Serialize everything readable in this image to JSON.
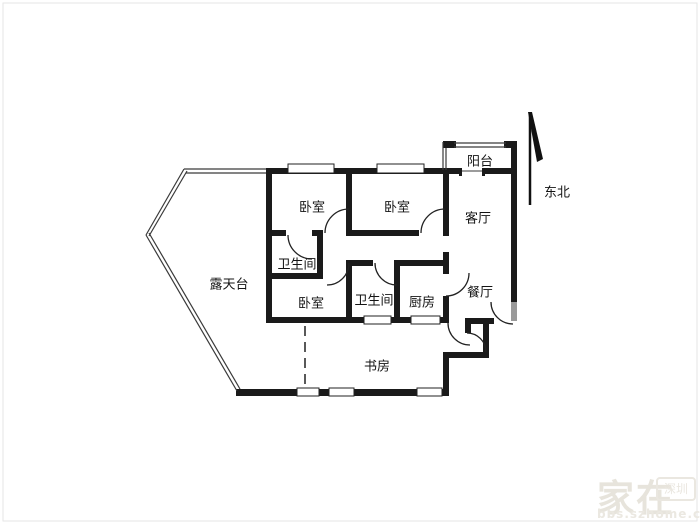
{
  "floorplan": {
    "rooms": [
      {
        "id": "balcony",
        "label": "阳台"
      },
      {
        "id": "bedroom-top-left",
        "label": "卧室"
      },
      {
        "id": "bedroom-top-right",
        "label": "卧室"
      },
      {
        "id": "living-room",
        "label": "客厅"
      },
      {
        "id": "bathroom-1",
        "label": "卫生间"
      },
      {
        "id": "terrace",
        "label": "露天台"
      },
      {
        "id": "bedroom-bottom",
        "label": "卧室"
      },
      {
        "id": "bathroom-2",
        "label": "卫生间"
      },
      {
        "id": "kitchen",
        "label": "厨房"
      },
      {
        "id": "dining-room",
        "label": "餐厅"
      },
      {
        "id": "study",
        "label": "书房"
      }
    ],
    "compass": {
      "label": "东北"
    },
    "watermark": {
      "title": "家在",
      "badge": "深圳",
      "url": "bbs.szhome.com"
    },
    "colors": {
      "wall": "#1a1a1a",
      "thin_line": "#3a3a3a",
      "door_arc": "#222222",
      "watermark": "#e7e4dc"
    }
  }
}
